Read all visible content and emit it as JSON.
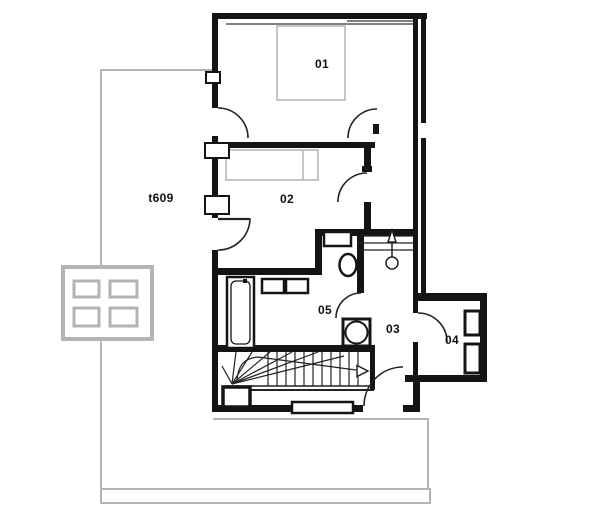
{
  "plan": {
    "rooms": [
      {
        "number": "01"
      },
      {
        "number": "02"
      },
      {
        "number": "03"
      },
      {
        "number": "04"
      },
      {
        "number": "05"
      }
    ],
    "terrace": {
      "label": "t609"
    },
    "colors": {
      "wall": "#141414",
      "lower_level": "#b3b3b3"
    }
  }
}
